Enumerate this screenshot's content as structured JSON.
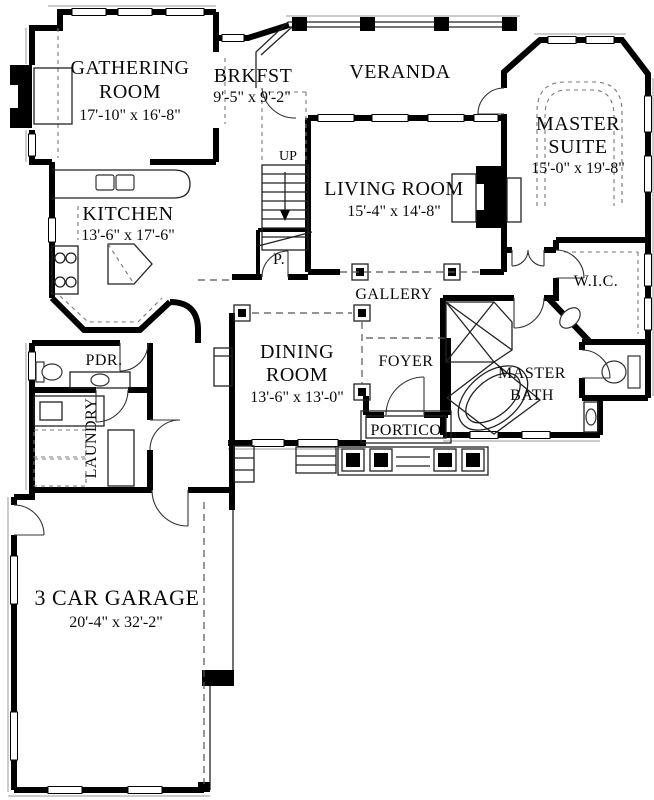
{
  "plan": {
    "type": "first-floor-plan",
    "colors": {
      "wall": "#000000",
      "background": "#ffffff",
      "thin_line": "#222222",
      "dashed_line": "#555555"
    },
    "rooms": {
      "gathering": {
        "line1": "GATHERING",
        "line2": "ROOM",
        "dims": "17'-10\" x 16'-8\""
      },
      "brkfst": {
        "line1": "BRKFST",
        "dims": "9'-5\" x 9'-2\""
      },
      "veranda": {
        "line1": "VERANDA"
      },
      "master_suite": {
        "line1": "MASTER",
        "line2": "SUITE",
        "dims": "15'-0\" x 19'-8\""
      },
      "kitchen": {
        "line1": "KITCHEN",
        "dims": "13'-6\" x 17'-6\""
      },
      "living": {
        "line1": "LIVING ROOM",
        "dims": "15'-4\" x 14'-8\""
      },
      "stairs": {
        "label": "UP"
      },
      "powder_small": {
        "label": "P."
      },
      "gallery": {
        "label": "GALLERY"
      },
      "wic": {
        "label": "W.I.C."
      },
      "pdr": {
        "label": "PDR."
      },
      "dining": {
        "line1": "DINING",
        "line2": "ROOM",
        "dims": "13'-6\" x 13'-0\""
      },
      "foyer": {
        "label": "FOYER"
      },
      "master_bath": {
        "line1": "MASTER",
        "line2": "BATH"
      },
      "laundry": {
        "label": "LAUNDRY"
      },
      "portico": {
        "label": "PORTICO"
      },
      "garage": {
        "line1": "3 CAR GARAGE",
        "dims": "20'-4\" x 32'-2\""
      }
    }
  }
}
